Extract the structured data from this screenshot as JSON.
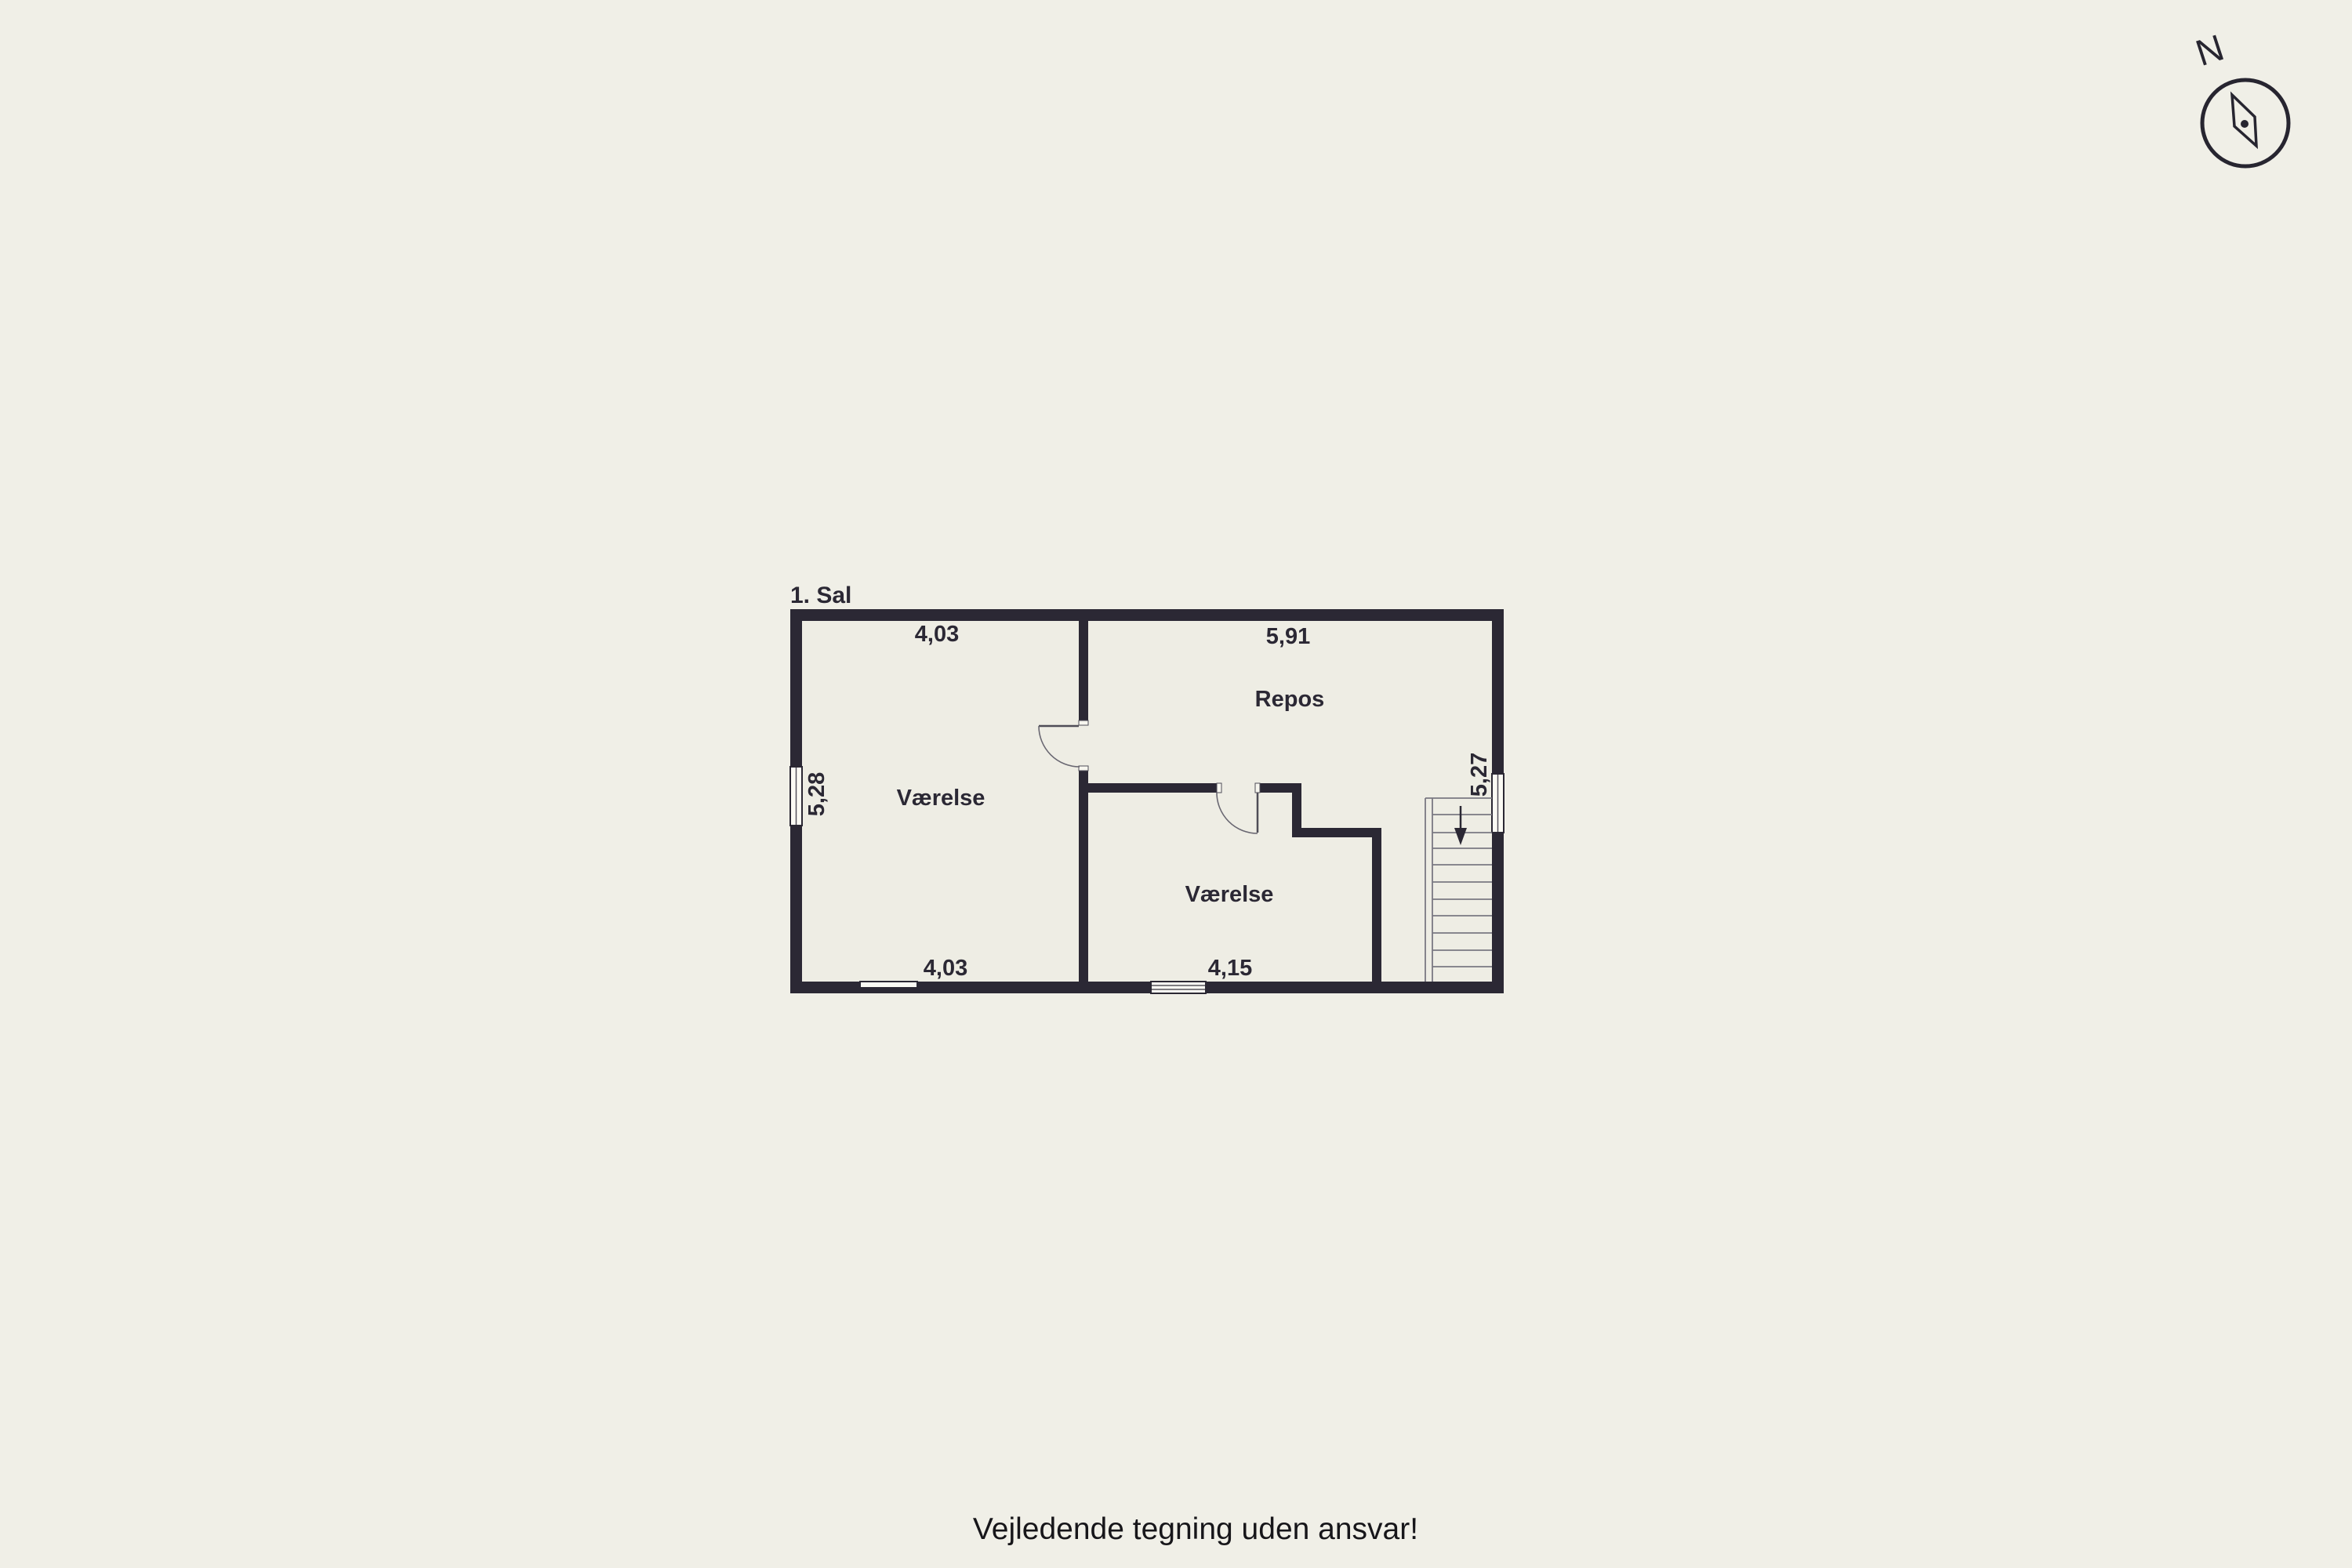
{
  "page": {
    "background_color": "#f0efe7",
    "disclaimer": "Vejledende tegning uden ansvar!"
  },
  "plan": {
    "floor_label": "1. Sal",
    "wall_color": "#2b2834",
    "floor_color": "#eeede4",
    "rooms": {
      "room1": "Værelse",
      "room2": "Værelse",
      "landing": "Repos"
    },
    "dims": {
      "top_left": "4,03",
      "top_right": "5,91",
      "left": "5,28",
      "right": "5,27",
      "bottom_left": "4,03",
      "bottom_right": "4,15"
    },
    "stairs_direction": "down"
  },
  "compass": {
    "north_label": "N"
  }
}
